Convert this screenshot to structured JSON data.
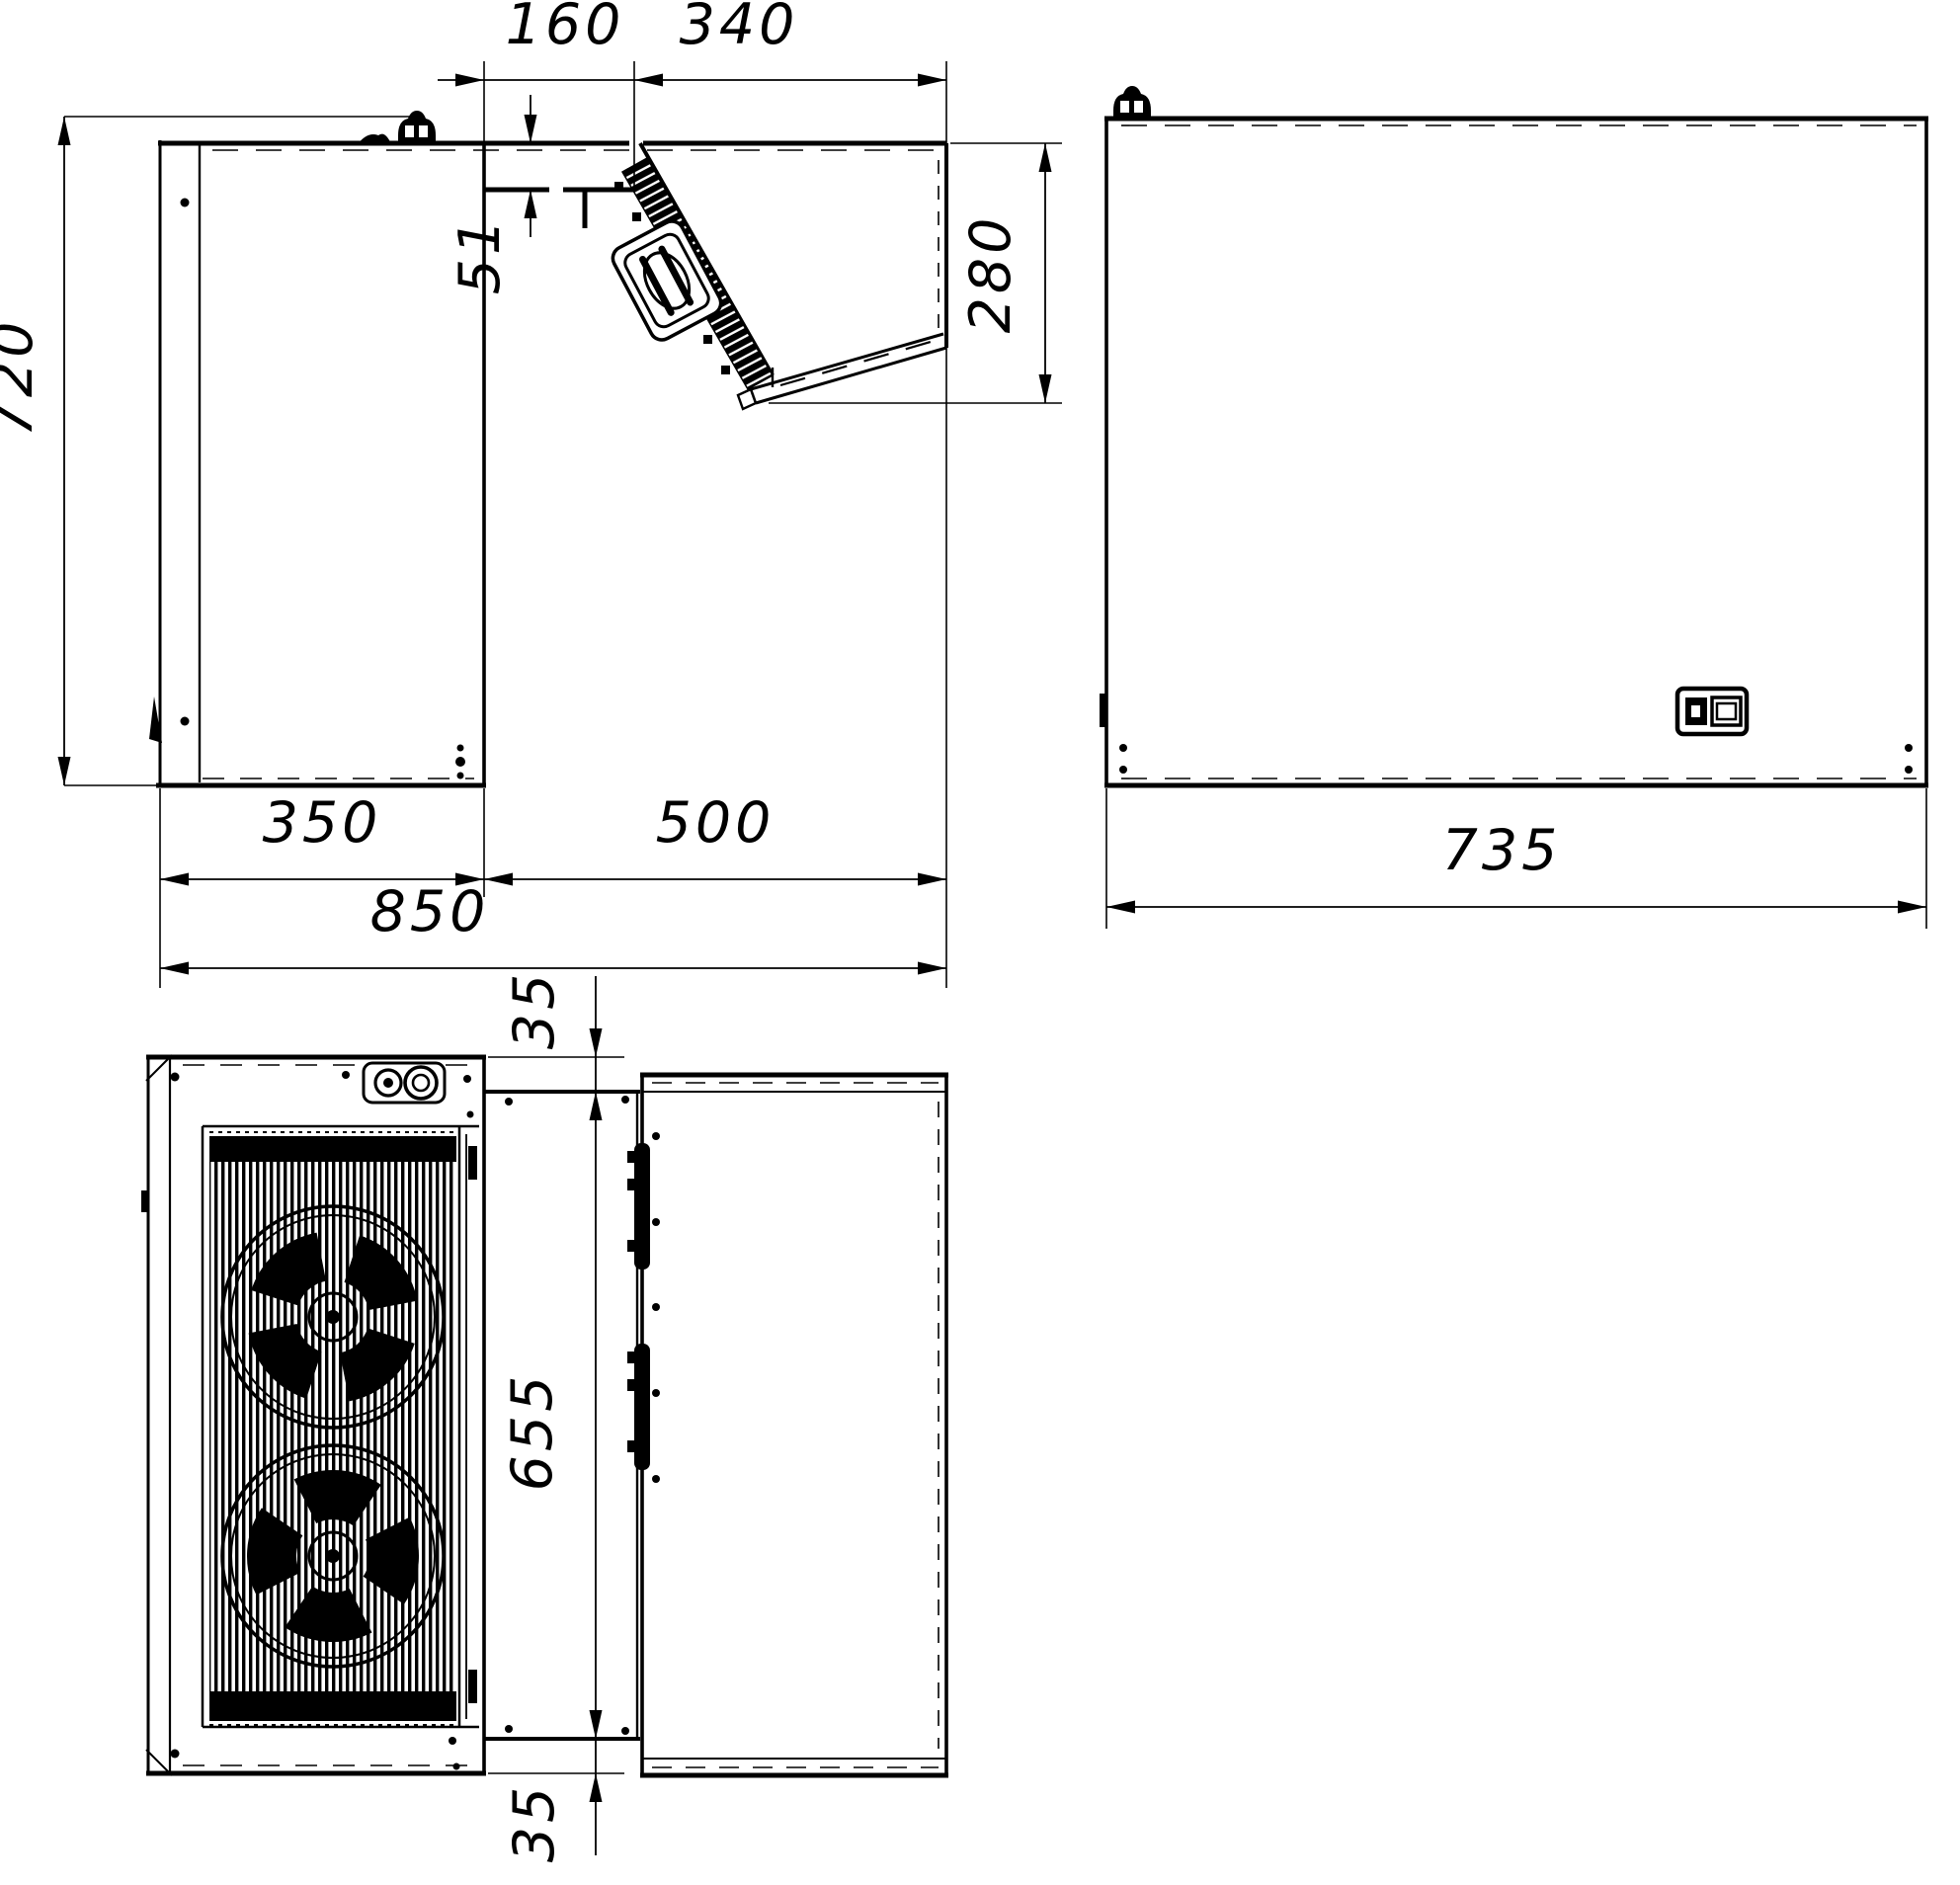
{
  "meta": {
    "type": "technical dimensional drawing",
    "subject": "corner refrigeration monoblock, three orthographic views",
    "units": "mm",
    "ink_color": "#000000",
    "paper_color": "#ffffff"
  },
  "side_view": {
    "height_total": "720",
    "wall_recess_depth": "160",
    "indoor_section_depth": "340",
    "ceiling_plate_thickness": "51",
    "indoor_section_height": "280",
    "outdoor_section_depth": "350",
    "indoor_span": "500",
    "total_depth": "850"
  },
  "front_view": {
    "width_total": "735"
  },
  "plan_view": {
    "side_clearance_top": "35",
    "wall_opening_width": "655",
    "side_clearance_bottom": "35"
  },
  "icons": {
    "service_valve": "dome cap with two windows",
    "condenser_fan": "ring with four blades behind grille bars",
    "fan_shroud": "tilted rounded rectangle with ellipse",
    "controller_display": "small panel with button and screen slot",
    "cable_gland": "two round fittings on plate"
  }
}
